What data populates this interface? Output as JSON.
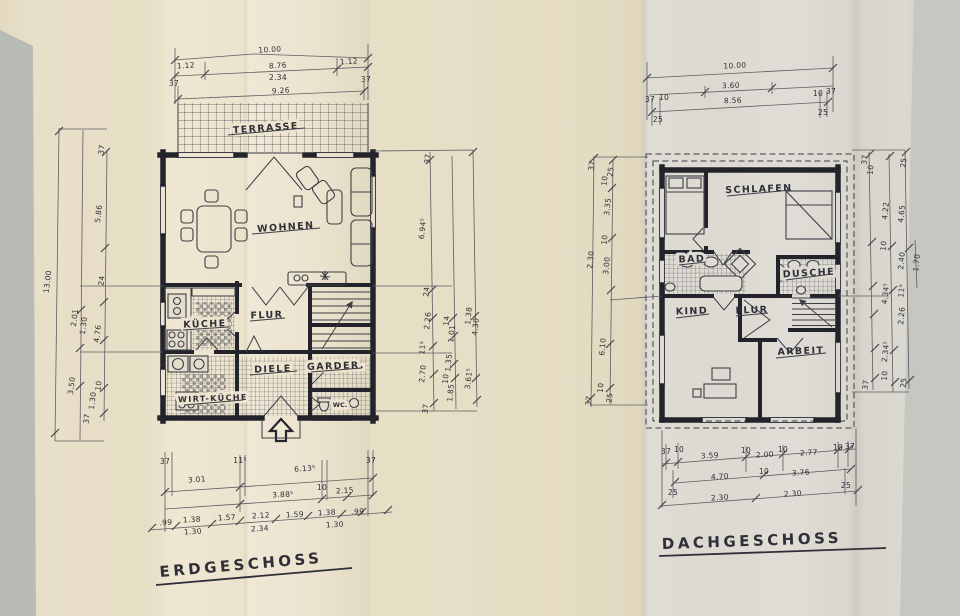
{
  "palette": {
    "backdrop": "#b9bcb5",
    "sheet_left": "#e8dfc8",
    "sheet_right": "#dcd9d1",
    "ink": "#2e2f37",
    "pencil": "#5c5d63",
    "wall": "#23242b"
  },
  "eg": {
    "title": "ERDGESCHOSS",
    "rooms": {
      "terrasse": "TERRASSE",
      "wohnen": "WOHNEN",
      "kueche": "KÜCHE",
      "flur": "FLUR",
      "diele": "DIELE",
      "garderobe": "GARDER.",
      "wirtkueche": "WIRT-KÜCHE",
      "wc": "WC."
    },
    "dims_top": [
      "10.00",
      "1.12",
      "8.76",
      "1.12",
      "2.34",
      "9.26",
      "37",
      "37"
    ],
    "dims_left": [
      "13.00",
      "37",
      "5.86",
      "24",
      "2.01",
      "1.30",
      "4.76",
      "3.50",
      "10",
      "1.30",
      "37"
    ],
    "dims_right": [
      "37",
      "6.94⁵",
      "24",
      "2.26",
      "14",
      "1.01",
      "1.38",
      "4.30",
      "11⁵",
      "2.70",
      "1.35",
      "10",
      "1.85",
      "3.61⁵",
      "37"
    ],
    "dims_bottom": [
      "37",
      "3.01",
      "11⁵",
      "6.13⁵",
      "37",
      "3.88⁵",
      "10",
      "2.15",
      ".99",
      "1.38",
      "1.57",
      "2.12",
      "1.59",
      "1.38",
      ".99",
      "1.30",
      "2.34",
      "1.30"
    ]
  },
  "dg": {
    "title": "DACHGESCHOSS",
    "rooms": {
      "schlafen": "SCHLAFEN",
      "bad": "BAD",
      "dusche": "DUSCHE",
      "kind": "KIND",
      "flur": "FLUR",
      "arbeit": "ARBEIT"
    },
    "dims_top": [
      "10.00",
      "3.60",
      "8.56",
      "37",
      "10",
      "25",
      "10",
      "37",
      "25"
    ],
    "dims_left": [
      "37",
      "25",
      "10",
      "3.35",
      "10",
      "2.30",
      "3.00",
      "6.10",
      "10",
      "37",
      "25"
    ],
    "dims_right": [
      "37",
      "10",
      "25",
      "4.22",
      "4.65",
      "10",
      "2.40",
      "1.70",
      "4.34⁵",
      "11⁵",
      "2.26",
      "2.34⁵",
      "10",
      "37",
      "25"
    ],
    "dims_bottom": [
      "37",
      "10",
      "3.59",
      "10",
      "2.00",
      "10",
      "2.77",
      "10",
      "37",
      "25",
      "4.70",
      "10",
      "3.76",
      "25",
      "2.30",
      "2.30"
    ]
  }
}
